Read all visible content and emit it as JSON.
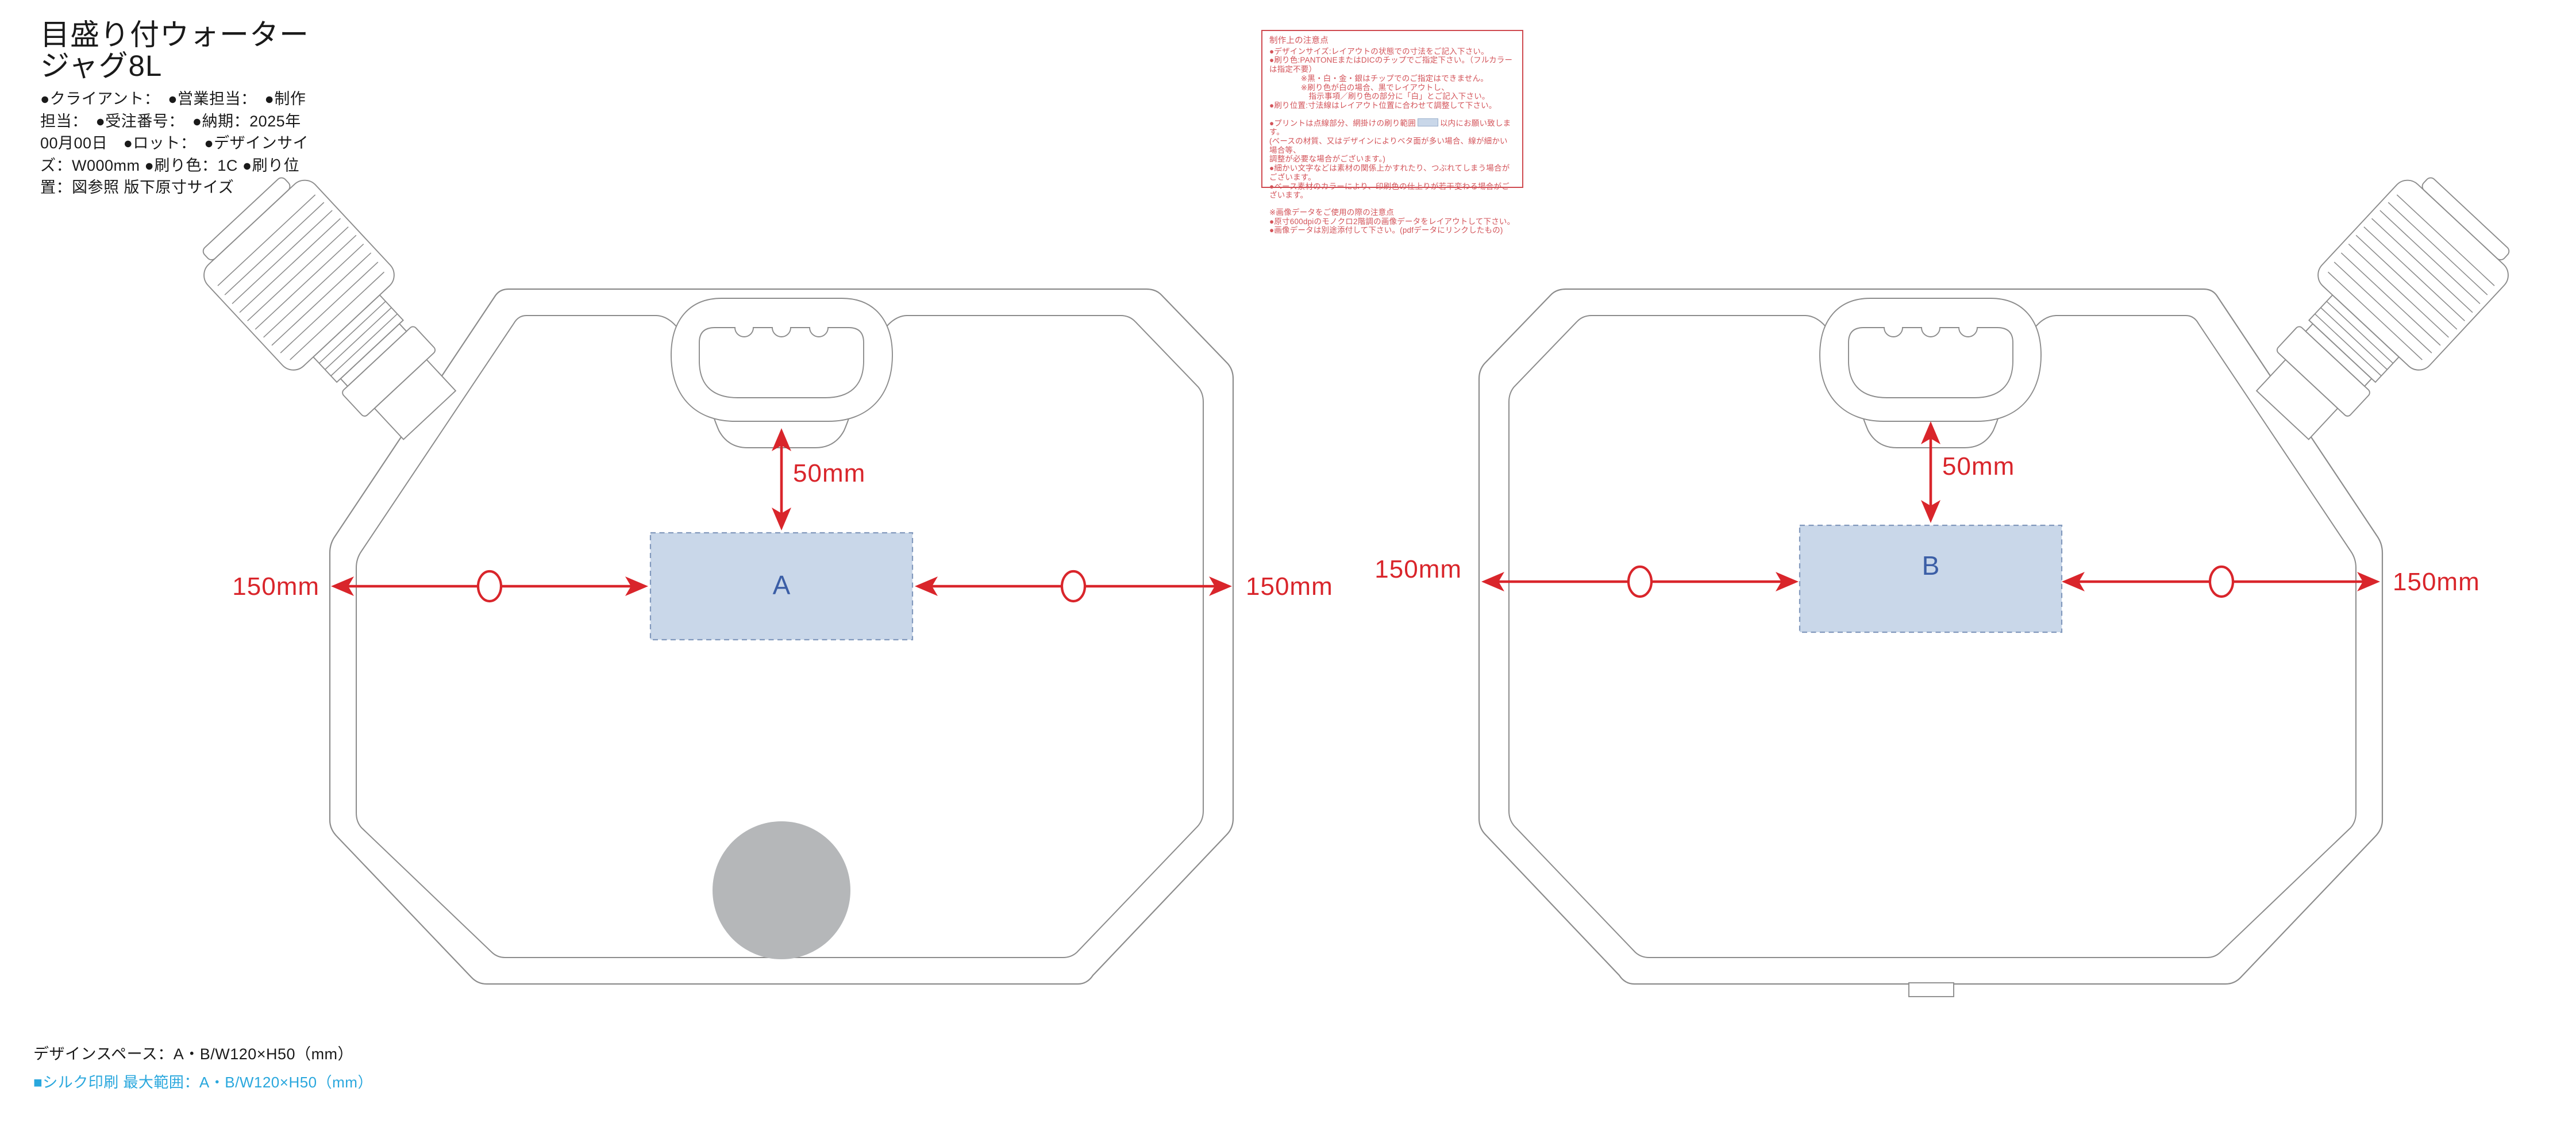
{
  "header": {
    "title": "目盛り付ウォータージャグ8L",
    "meta": "●クライアント：　●営業担当：　●制作担当：　●受注番号：　●納期：2025年00月00日　●ロット：　●デザインサイズ：W000mm ●刷り色：1C ●刷り位置：図参照 版下原寸サイズ"
  },
  "notes": {
    "title": "制作上の注意点",
    "lines": [
      "●デザインサイズ:レイアウトの状態での寸法をご記入下さい。",
      "●刷り色:PANTONEまたはDICのチップでご指定下さい。（フルカラーは指定不要）",
      "　　　　※黒・白・金・銀はチップでのご指定はできません。",
      "　　　　※刷り色が白の場合、黒でレイアウトし、",
      "　　　　　指示事項／刷り色の部分に「白」とご記入下さい。",
      "●刷り位置:寸法線はレイアウト位置に合わせて調整して下さい。",
      "(ベースの材質、又はデザインによりベタ面が多い場合、線が細かい場合等、",
      "調整が必要な場合がございます。)",
      "●細かい文字などは素材の関係上かすれたり、つぶれてしまう場合がございます。",
      "●ベース素材のカラーにより、印刷色の仕上りが若干変わる場合がございます。",
      "※画像データをご使用の際の注意点",
      "●原寸600dpiのモノクロ2階調の画像データをレイアウトして下さい。",
      "●画像データは別途添付して下さい。(pdfデータにリンクしたもの)"
    ],
    "print_range_before": "●プリントは点線部分、網掛けの刷り範囲",
    "print_range_after": "以内にお願い致します。"
  },
  "diagram": {
    "jug_front_label": "A",
    "jug_back_label": "B",
    "dims": {
      "a_left": "150mm",
      "a_right": "150mm",
      "a_top": "50mm",
      "b_left": "150mm",
      "b_right": "150mm",
      "b_top": "50mm"
    }
  },
  "footer": {
    "design_space": "デザインスペース：A・B/W120×H50（mm）",
    "silk_print": "■シルク印刷 最大範囲：A・B/W120×H50（mm）"
  },
  "colors": {
    "dimension_red": "#d9252b",
    "design_space_fill": "#c9d7e9",
    "design_space_border": "#8299bd",
    "space_letter_blue": "#3b5ea6",
    "outline_gray": "#8c8c8c",
    "notes_red": "#d35359",
    "silk_print_cyan": "#29a7dd",
    "bottom_circle_gray": "#b5b7b9"
  }
}
